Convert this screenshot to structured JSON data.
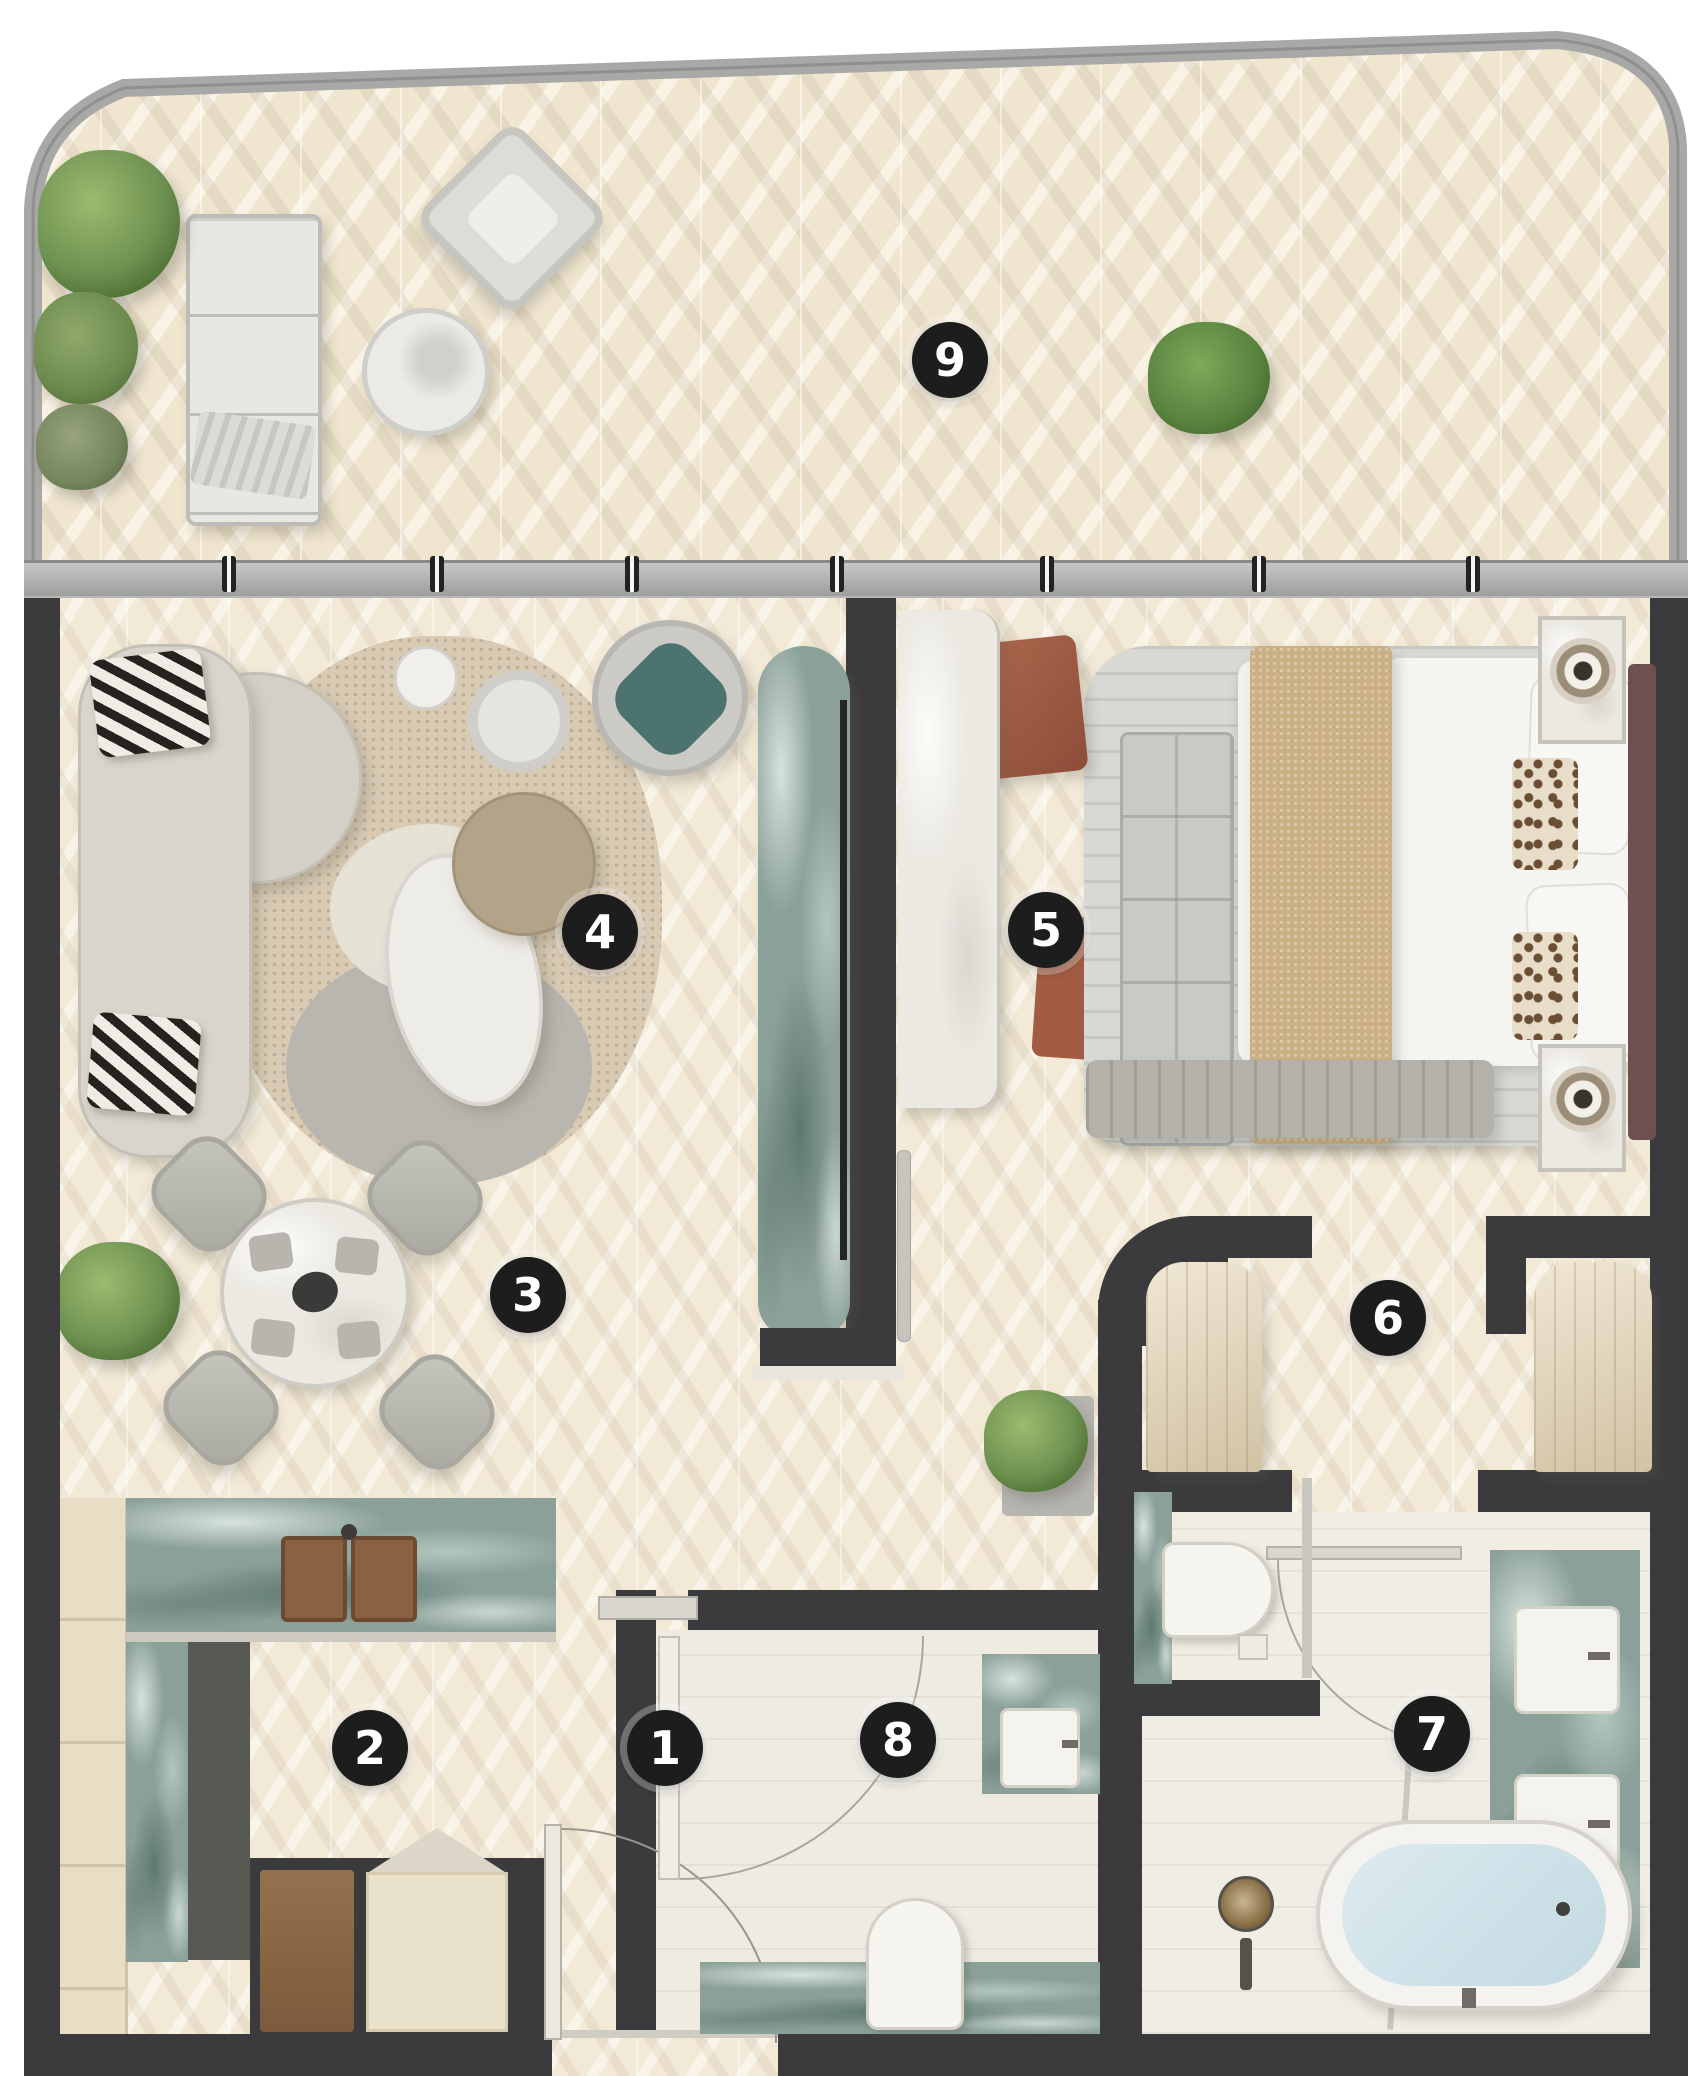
{
  "title": "Residential unit floor plan (top view render)",
  "markers": [
    {
      "label": "1",
      "x": 665,
      "y": 1748
    },
    {
      "label": "2",
      "x": 370,
      "y": 1748
    },
    {
      "label": "3",
      "x": 528,
      "y": 1295
    },
    {
      "label": "4",
      "x": 600,
      "y": 932
    },
    {
      "label": "5",
      "x": 1046,
      "y": 930
    },
    {
      "label": "6",
      "x": 1388,
      "y": 1318
    },
    {
      "label": "7",
      "x": 1432,
      "y": 1734
    },
    {
      "label": "8",
      "x": 898,
      "y": 1740
    },
    {
      "label": "9",
      "x": 950,
      "y": 360
    }
  ],
  "colors": {
    "wall": "#3b3b3d",
    "floor_cream": "#f2e9d7",
    "balcony_floor": "#f0e6d0",
    "bath_floor": "#eeebe2",
    "railing": "#a8a8a6",
    "marble_green": "#8aa098",
    "marble_white": "#ebe9e2",
    "wood_tan": "#e5d7b8",
    "accent_rust": "#a25c43",
    "accent_teal": "#4c7370",
    "blanket_tan": "#cbb086",
    "tub_water": "#c3d9e1",
    "marker_bg": "#1d1d1d",
    "marker_text": "#ffffff"
  }
}
